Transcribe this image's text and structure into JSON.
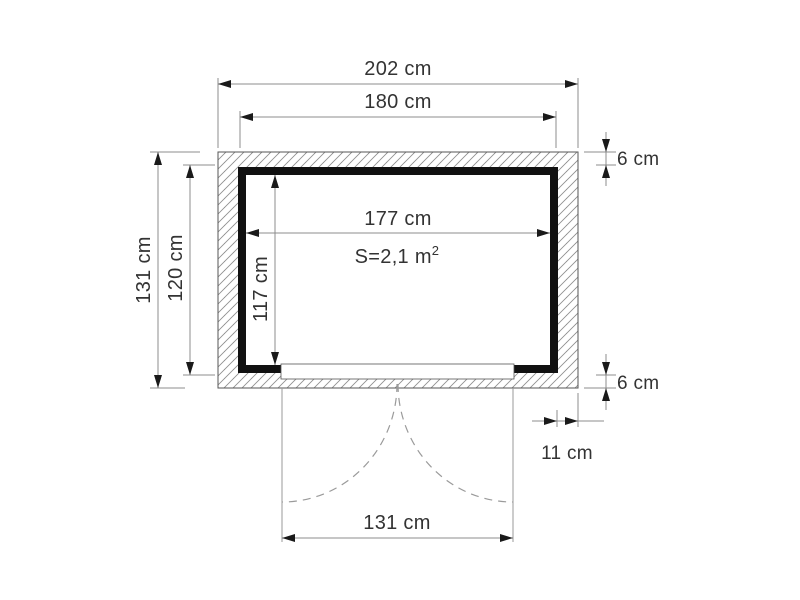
{
  "diagram": {
    "type": "shed-floor-plan-top-view",
    "background": "#ffffff",
    "labels": {
      "overall_width": "202 cm",
      "frame_width": "180 cm",
      "interior_width": "177 cm",
      "interior_depth": "117 cm",
      "overall_depth": "131 cm",
      "frame_depth": "120 cm",
      "wall_thickness_top": "6 cm",
      "wall_thickness_bottom": "6 cm",
      "door_side_offset": "11 cm",
      "door_width": "131 cm",
      "area": "S=2,1 m",
      "area_superscript": "2"
    },
    "colors": {
      "wall_inner_line": "#111111",
      "hatch_line": "#8f8f8f",
      "dimension_line": "#8c8c8c",
      "arrowhead": "#1a1a1a",
      "text": "#333333",
      "door_swing": "#9a9a9a",
      "thin_outline": "#555555"
    }
  }
}
